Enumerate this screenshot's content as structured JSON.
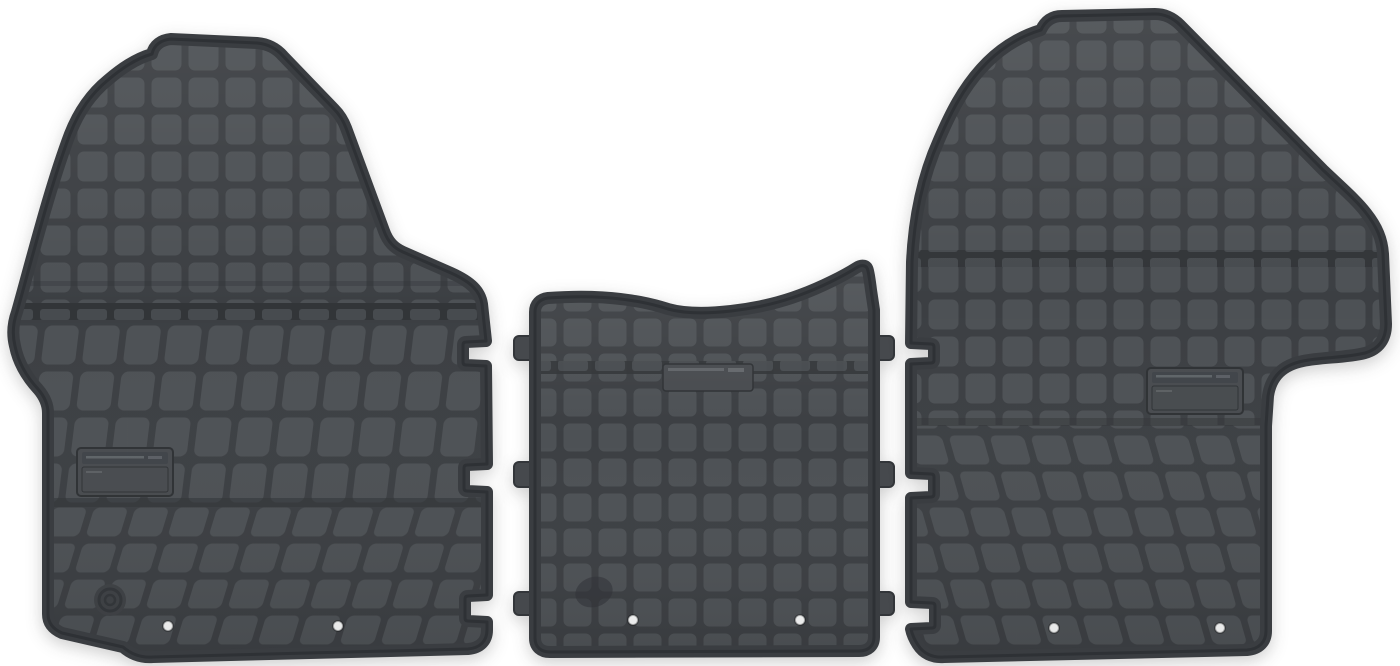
{
  "scene": {
    "type": "product-photo",
    "description": "Set of three dark grey rubber car floor mats (driver-side mat, centre tunnel mat, passenger-side mat) laid flat on a white background, each with an embossed square-grid anti-slip texture",
    "background_color": "#ffffff"
  },
  "colors": {
    "background": "#ffffff",
    "cell": "#4d5155",
    "cell_flat": "#474b4f",
    "gap": "#3c3f43",
    "border": "#3a3d41",
    "edge": "#2e3135",
    "rail": "#323538",
    "plate_fill": "#484b4f",
    "plate_strip": "#404449",
    "plate_edge": "#2e3134",
    "plate_text": "#9aa0a4",
    "tab": "#46494d",
    "hole": "#f7f8f8",
    "hole_ring": "rgba(0,0,0,0.28)",
    "emblem": "#33363a",
    "emblem_boss": "#3f4246",
    "smudge": "#2f3236"
  },
  "mats": {
    "left": {
      "name": "driver-side rubber floor mat",
      "texture": "embossed square grid, skewed rows toward bottom",
      "features": [
        "embossed label plate",
        "round emblem stamp",
        "two fixing holes",
        "three connector notches on right edge"
      ]
    },
    "middle": {
      "name": "centre tunnel rubber mat",
      "texture": "embossed square grid, concave top edge",
      "features": [
        "embossed label plate",
        "three connector tabs on each side",
        "two fixing holes",
        "dark wear spot"
      ]
    },
    "right": {
      "name": "passenger-side rubber floor mat",
      "texture": "embossed square grid, skewed rows toward bottom",
      "features": [
        "embossed label plate",
        "two fixing holes",
        "three connector notches on left edge",
        "side bulge on right edge"
      ]
    }
  }
}
